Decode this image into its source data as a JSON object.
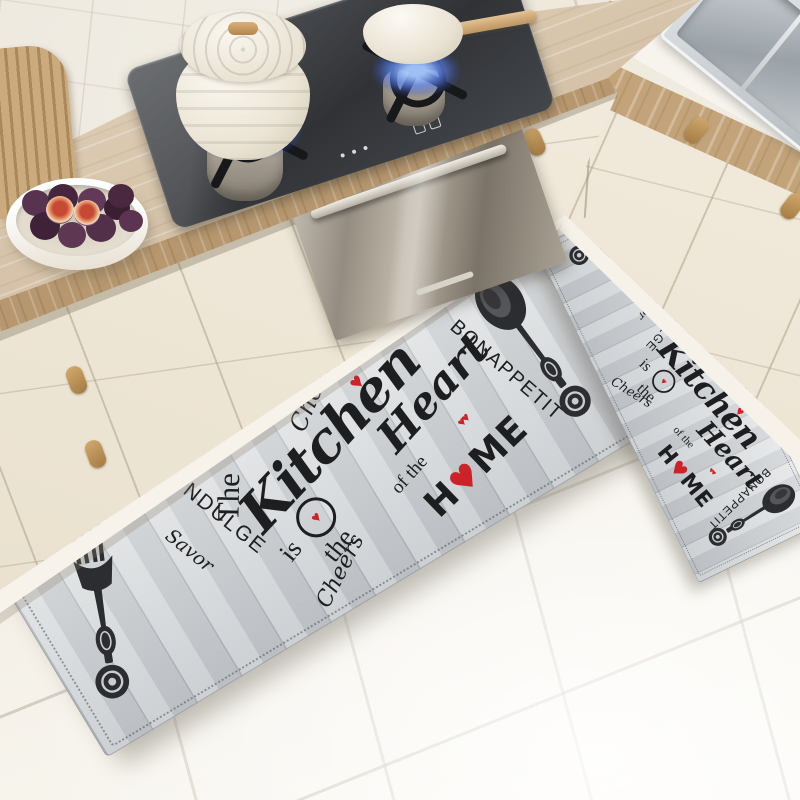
{
  "scene": {
    "description": "Kitchen with cream cabinets, wood countertop, gas cooktop with two white pots on blue flames, built-in stainless oven, stainless sink, bowl of figs, slatted wood board, and a two-piece farmhouse kitchen mat set lying on white tile floor"
  },
  "colors": {
    "mat_base": "#d6d9dc",
    "mat_text": "#1d1e20",
    "heart_red": "#cc2229",
    "wood_counter": "#cfb591",
    "cabinet_cream": "#efe7d9",
    "cooktop_glass": "#35373b",
    "flame_blue": "#5a82eb",
    "oven_steel": "#a39b8f",
    "floor_tile": "#f4f0e7",
    "fig_purple": "#53304a"
  },
  "icons": {
    "fork": "fork-illustration",
    "spoon": "spoon-illustration",
    "heart": "heart-icon",
    "swirl": "swirl-circle-icon"
  },
  "mat": {
    "words": {
      "the": "The",
      "kitchen": "Kitchen",
      "is": "is",
      "the2": "the",
      "heart_word": "Heart",
      "of_the": "of the",
      "home_h": "H",
      "home_o_heart": "♥",
      "home_me": "ME",
      "cheers": "Cheers",
      "bon_appetit": "BONAPPETIT",
      "savor": "Savor",
      "indulge": "INDULGE",
      "heart": "♥",
      "double_hearts": "♥♥",
      "swirl_heart": "♥"
    }
  }
}
